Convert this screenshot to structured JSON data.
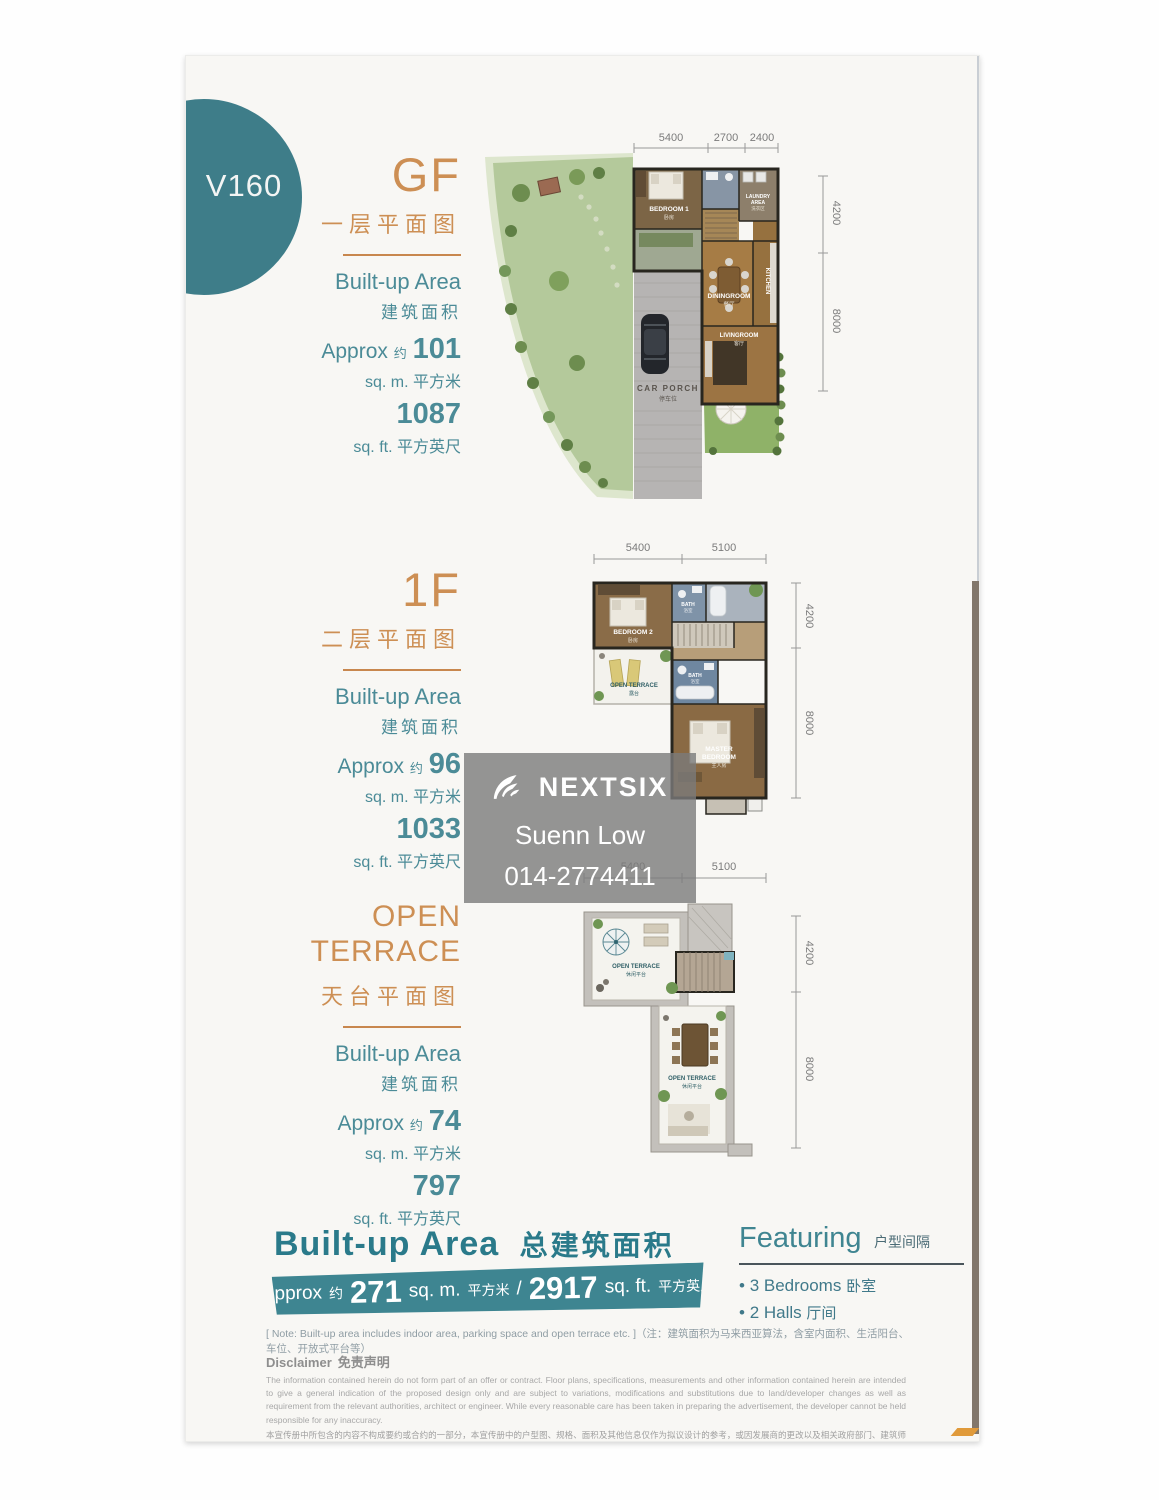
{
  "badge": {
    "label": "V160"
  },
  "watermark": {
    "brand": "NEXTSIX",
    "agent": "Suenn Low",
    "phone": "014-2774411"
  },
  "floors": [
    {
      "title": "GF",
      "subtitle_cn": "一层平面图",
      "builtup_en": "Built-up Area",
      "builtup_cn": "建筑面积",
      "approx_en": "Approx",
      "approx_cn": "约",
      "sqm_value": "101",
      "sqm_unit": "sq. m.",
      "sqm_unit_cn": "平方米",
      "sqft_value": "1087",
      "sqft_unit": "sq. ft.",
      "sqft_unit_cn": "平方英尺",
      "dims_top": [
        "5400",
        "2700",
        "2400"
      ],
      "dims_right": [
        "4200",
        "8000"
      ],
      "rooms": {
        "bedroom1": "BEDROOM 1",
        "bedroom1_cn": "卧房",
        "laundry1": "LAUNDRY",
        "laundry2": "AREA",
        "laundry_cn": "洗衣区",
        "kitchen": "KITCHEN",
        "dining": "DININGROOM",
        "dining_cn": "餐厅",
        "living": "LIVINGROOM",
        "living_cn": "客厅",
        "carporch": "CAR PORCH",
        "carporch_cn": "停车位"
      }
    },
    {
      "title": "1F",
      "subtitle_cn": "二层平面图",
      "builtup_en": "Built-up Area",
      "builtup_cn": "建筑面积",
      "approx_en": "Approx",
      "approx_cn": "约",
      "sqm_value": "96",
      "sqm_unit": "sq. m.",
      "sqm_unit_cn": "平方米",
      "sqft_value": "1033",
      "sqft_unit": "sq. ft.",
      "sqft_unit_cn": "平方英尺",
      "dims_top": [
        "5400",
        "5100"
      ],
      "dims_right": [
        "4200",
        "8000"
      ],
      "rooms": {
        "bedroom2": "BEDROOM 2",
        "bedroom2_cn": "卧房",
        "bath1": "BATH",
        "bath1_cn": "浴室",
        "bath2": "BATH",
        "bath2_cn": "浴室",
        "terrace": "OPEN TERRACE",
        "terrace_cn": "露台",
        "master1": "MASTER",
        "master2": "BEDROOM",
        "master_cn": "主人房"
      }
    },
    {
      "title": "OPEN TERRACE",
      "subtitle_cn": "天台平面图",
      "builtup_en": "Built-up Area",
      "builtup_cn": "建筑面积",
      "approx_en": "Approx",
      "approx_cn": "约",
      "sqm_value": "74",
      "sqm_unit": "sq. m.",
      "sqm_unit_cn": "平方米",
      "sqft_value": "797",
      "sqft_unit": "sq. ft.",
      "sqft_unit_cn": "平方英尺",
      "dims_top": [
        "5400",
        "5100"
      ],
      "dims_right": [
        "4200",
        "8000"
      ],
      "rooms": {
        "terrace1": "OPEN TERRACE",
        "terrace1_cn": "休闲平台",
        "terrace2": "OPEN TERRACE",
        "terrace2_cn": "休闲平台"
      }
    }
  ],
  "summary": {
    "title_en": "Built-up Area",
    "title_cn": "总建筑面积",
    "approx_en": "Approx",
    "approx_cn": "约",
    "sqm_value": "271",
    "sqm_unit": "sq. m.",
    "sqm_unit_cn": "平方米",
    "separator": "/",
    "sqft_value": "2917",
    "sqft_unit": "sq. ft.",
    "sqft_unit_cn": "平方英尺"
  },
  "featuring": {
    "title_en": "Featuring",
    "title_cn": "户型间隔",
    "items": [
      {
        "en": "3 Bedrooms",
        "cn": "卧室"
      },
      {
        "en": "2 Halls",
        "cn": "厅间"
      }
    ]
  },
  "note": "[ Note:  Built-up area includes indoor area, parking space and open terrace etc. ]（注：建筑面积为马来西亚算法，含室内面积、生活阳台、车位、开放式平台等）",
  "disclaimer": {
    "title_en": "Disclaimer",
    "title_cn": "免责声明",
    "body_en": "The information contained herein do not form part of an offer or contract. Floor plans, specifications, measurements and other information contained herein are intended to give a general indication of the proposed design only and are subject to variations, modifications and substitutions due to land/developer changes as well as requirement from the relevant authorities, architect or engineer. While every reasonable care has been taken in preparing the advertisement, the developer cannot be held responsible for any inaccuracy.",
    "body_cn": "本宣传册中所包含的内容不构成要约或合约的一部分，本宣传册中的户型图、规格、面积及其他信息仅作为拟议设计的参考，或因发展商的更改以及相关政府部门、建筑师或工程师的要求而有所变更。发展商在编制本广告时已尽一切合理谨慎，对任何不准确之处概不负责。"
  }
}
